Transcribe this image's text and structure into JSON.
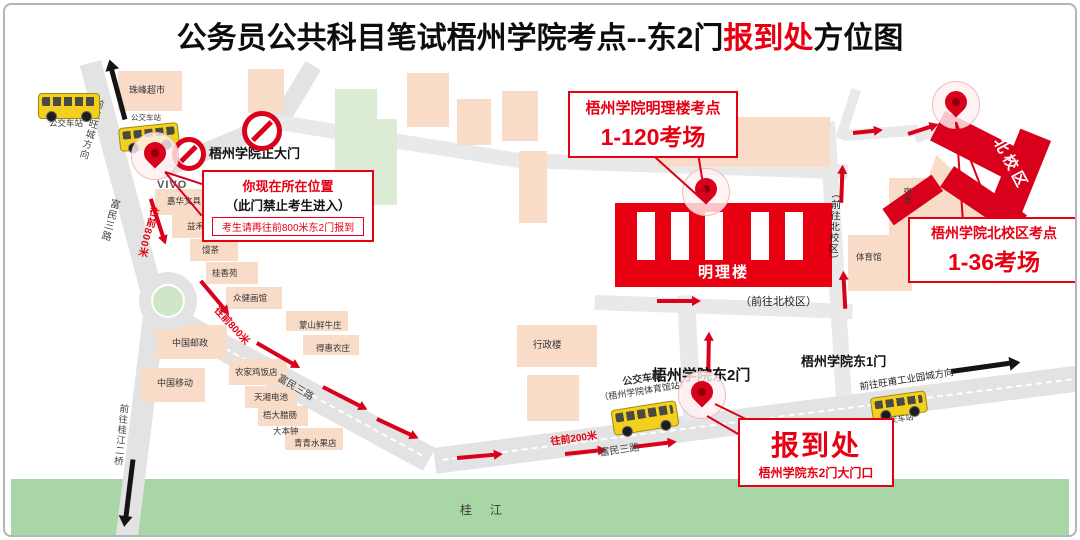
{
  "title": {
    "part1": "公务员公共科目笔试梧州学院考点--东2门",
    "highlight": "报到处",
    "part2": "方位图"
  },
  "colors": {
    "accent": "#e60012",
    "road": "#e3e3e3",
    "building": "#f8dcc8",
    "river": "#a9d6a6",
    "bus": "#f3cf1e"
  },
  "callouts": {
    "you_are_here": {
      "line1": "你现在所在位置",
      "line2": "（此门禁止考生进入）",
      "line3": "考生请再往前800米东2门报到"
    },
    "mingli": {
      "title": "梧州学院明理楼考点",
      "rooms": "1-120考场"
    },
    "north": {
      "title": "梧州学院北校区考点",
      "rooms": "1-36考场"
    },
    "checkin": {
      "title": "报到处",
      "subtitle": "梧州学院东2门大门口"
    }
  },
  "gates": {
    "main_gate": "梧州学院正大门",
    "east_gate_2": "梧州学院东2门",
    "east_gate_1": "梧州学院东1门"
  },
  "campus": {
    "mingli_building": "明理楼",
    "north_campus": "北校区",
    "library": "图书馆",
    "admin_building": "行政楼",
    "gym": "体育馆",
    "dorm": "宿舍"
  },
  "places": {
    "supermarket": "珠峰超市",
    "vivo": "VIVO",
    "stationery": "嘉华文具",
    "milk_tea": "益禾堂",
    "tea_shop": "馒茶",
    "guixiangyuan": "桂香苑",
    "art_gallery": "众健画馆",
    "china_post": "中国邮政",
    "china_mobile": "中国移动",
    "chicken_restaurant": "农家鸡饭店",
    "battery_shop": "天湘电池",
    "sausage_shop": "梧大腊肠",
    "dabenzhong": "大本钟",
    "fruit_shop": "青青水果店",
    "beef_restaurant": "蒙山鲜牛庄",
    "farm_restaurant": "得惠农庄"
  },
  "roads": {
    "fumin_road": "富民三路",
    "to_wangcheng": "前往旺城方向",
    "to_guijiang_bridge": "前往桂江二桥",
    "to_wangfu_industrial": "前往旺甫工业园城方向",
    "to_north_campus": "（前往北校区）"
  },
  "route_hints": {
    "ahead_800m": "往前800米",
    "ahead_200m": "往前200米"
  },
  "transit": {
    "bus_stop": "公交车站",
    "gym_station_line1": "公交车站",
    "gym_station_line2": "（梧州学院体育馆站）"
  },
  "river": {
    "name": "桂江"
  }
}
